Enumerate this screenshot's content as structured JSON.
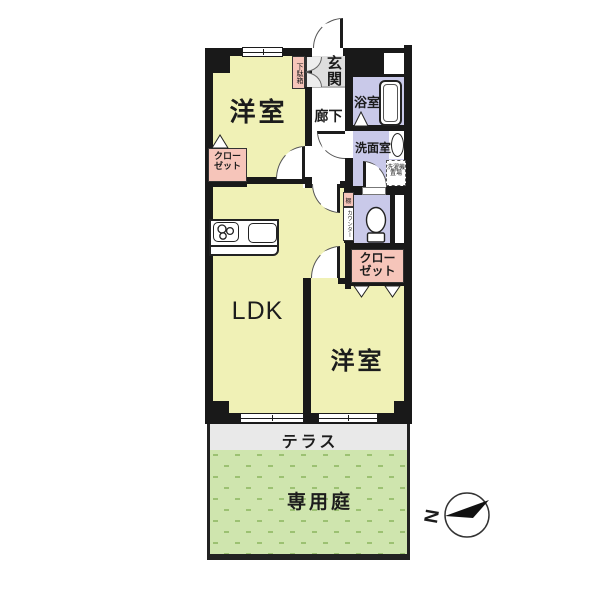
{
  "plan": {
    "rooms": {
      "bedroom_top_left": "洋室",
      "entrance": "玄関",
      "hallway": "廊下",
      "bathroom": "浴室",
      "washroom": "洗面室",
      "ldk": "LDK",
      "bedroom_bottom_right": "洋室",
      "terrace": "テラス",
      "private_garden": "専用庭"
    },
    "fixtures": {
      "shoe_cabinet": "下駄箱",
      "laundry_line1": "洗濯機",
      "laundry_line2": "置場",
      "closet_line1": "クロー",
      "closet_line2": "ゼット",
      "shelf": "棚",
      "counter": "カウンター"
    },
    "compass": {
      "north_label": "N"
    },
    "colors": {
      "wall": "#191919",
      "room_yellow": "#f0f1b6",
      "wet_area_purple": "#c9c9e9",
      "closet_pink": "#f6c5ba",
      "entrance_gray": "#dedede",
      "terrace_gray": "#e9e9e9",
      "garden_green": "#cfe5ae",
      "garden_dash_green": "#9cc172"
    }
  }
}
